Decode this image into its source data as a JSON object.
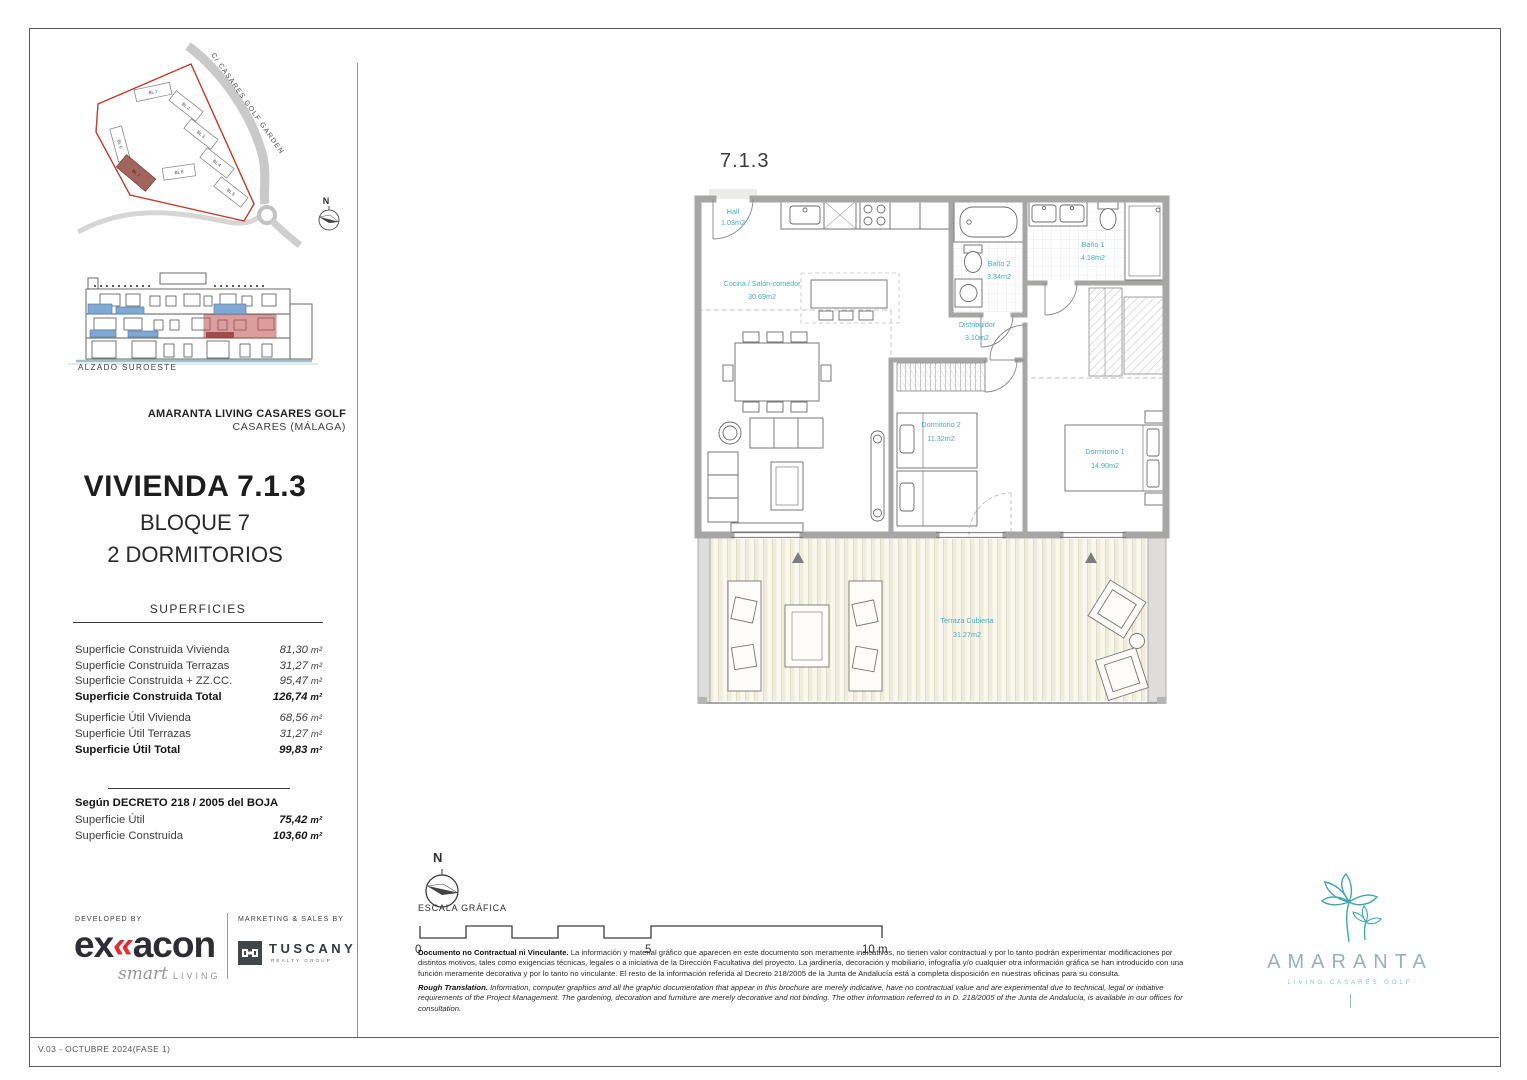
{
  "page": {
    "footer_version": "V.03 - OCTUBRE 2024(FASE 1)"
  },
  "site_plan": {
    "street": "C/ CASARES GOLF GARDEN",
    "north": "N",
    "blocks": [
      "BL 1",
      "BL 2",
      "BL 3",
      "BL 4",
      "BL 5",
      "BL 6",
      "BL 7",
      "BL 8"
    ]
  },
  "elevation": {
    "caption": "ALZADO SUROESTE"
  },
  "project": {
    "name": "AMARANTA LIVING CASARES GOLF",
    "location": "CASARES  (MÁLAGA)"
  },
  "unit": {
    "title": "VIVIENDA 7.1.3",
    "block": "BLOQUE 7",
    "type": "2 DORMITORIOS"
  },
  "superficies": {
    "heading": "SUPERFICIES",
    "rows": [
      {
        "label": "Superficie Construida Vivienda",
        "value": "81,30",
        "unit": "m²"
      },
      {
        "label": "Superficie Construida Terrazas",
        "value": "31,27",
        "unit": "m²"
      },
      {
        "label": "Superficie Construida + ZZ.CC.",
        "value": "95,47",
        "unit": "m²"
      },
      {
        "label": "Superficie Construida Total",
        "value": "126,74",
        "unit": "m²"
      },
      {
        "label": "Superficie Útil Vivienda",
        "value": "68,56",
        "unit": "m²"
      },
      {
        "label": "Superficie Útil Terrazas",
        "value": "31,27",
        "unit": "m²"
      },
      {
        "label": "Superficie Útil Total",
        "value": "99,83",
        "unit": "m²"
      }
    ]
  },
  "decreto": {
    "heading": "Según DECRETO 218 / 2005 del BOJA",
    "rows": [
      {
        "label": "Superficie Útil",
        "value": "75,42",
        "unit": "m²"
      },
      {
        "label": "Superficie Construida",
        "value": "103,60",
        "unit": "m²"
      }
    ]
  },
  "developer": {
    "caption": "DEVELOPED BY",
    "brand_pre": "ex",
    "brand_mark": "«",
    "brand_post": "acon",
    "tagline_script": "smart",
    "tagline_caps": "LIVING"
  },
  "sales": {
    "caption": "MARKETING & SALES BY",
    "brand": "TUSCANY",
    "brand_sub": "REALTY GROUP"
  },
  "plan": {
    "unit_label": "7.1.3",
    "rooms": [
      {
        "name": "Hall",
        "area": "1.03m2"
      },
      {
        "name": "Cocina / Salón-comedor",
        "area": "30.69m2"
      },
      {
        "name": "Baño 2",
        "area": "3.34m2"
      },
      {
        "name": "Baño 1",
        "area": "4.18m2"
      },
      {
        "name": "Distribuidor",
        "area": "3.10m2"
      },
      {
        "name": "Dormitorio 2",
        "area": "11.32m2"
      },
      {
        "name": "Dormitorio 1",
        "area": "14.90m2"
      },
      {
        "name": "Terraza Cubierta",
        "area": "31.27m2"
      }
    ]
  },
  "scale": {
    "north": "N",
    "caption": "ESCALA GRÁFICA",
    "tick0": "0",
    "tick5": "5",
    "tick10": "10 m"
  },
  "disclaimer": {
    "es_lead": "Documento no Contractual ni Vinculante.",
    "es_text": "La información y material gráfico que aparecen en este documento son meramente indicativos, no tienen valor contractual y por lo tanto podrán experimentar modificaciones por distintos motivos, tales como exigencias técnicas, legales o a iniciativa de la Dirección Facultativa del proyecto. La jardinería, decoración y mobiliario, infografía y/o cualquier otra información gráfica se han introducido con una función meramente decorativa y por lo tanto no vinculante. El resto de la información referida al Decreto 218/2005 de la Junta de Andalucía está a completa disposición en nuestras oficinas para su consulta.",
    "en_lead": "Rough Translation.",
    "en_text": "Information, computer graphics and all the graphic documentation that appear in this brochure are merely indicative, have no contractual value and are experimental due to technical, legal or initiative requirements of the Project Management. The gardening, decoration and furniture are merely decorative and not binding. The other information referred to in D. 218/2005 of the Junta de Andalucía, is available in our offices for consultation."
  },
  "brand": {
    "word": "AMARANTA",
    "sub": "LIVING CASARES GOLF"
  },
  "colors": {
    "teal_label": "#3fb0bf",
    "plot_red": "#c23a24",
    "logo_red": "#e22d2a",
    "highlight_red": "#c0504d",
    "window_blue": "#7fa9d4",
    "brand_teal": "#3da8ad"
  }
}
